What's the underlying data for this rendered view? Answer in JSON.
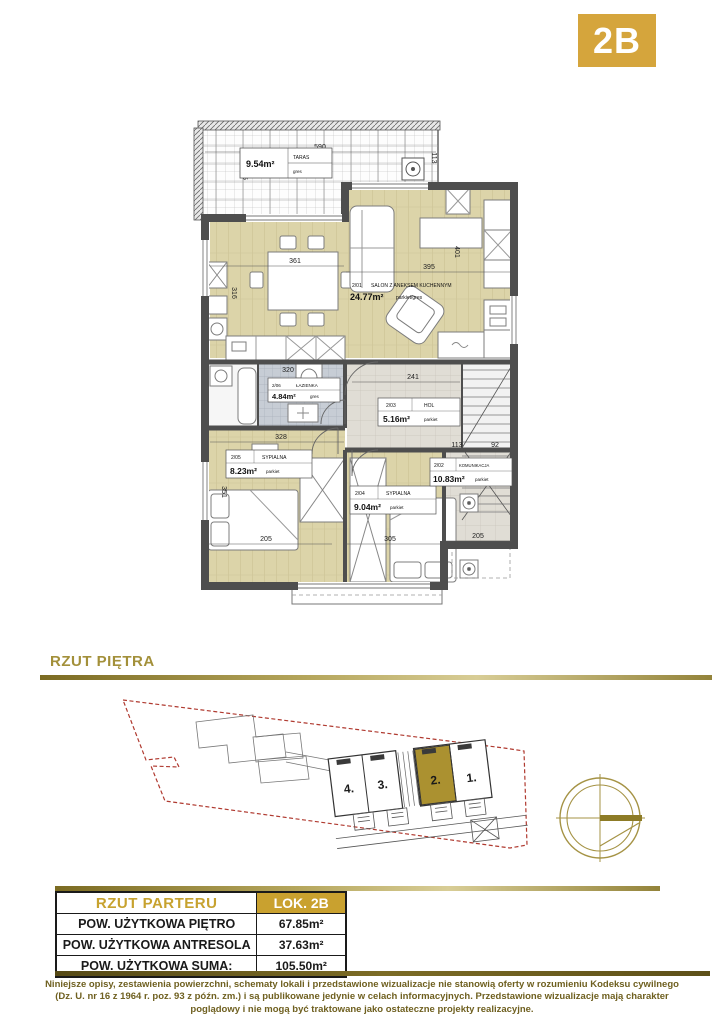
{
  "badge": {
    "label": "2B",
    "color": "#d5a53c"
  },
  "section_title": "RZUT PIĘTRA",
  "floor_plan": {
    "rooms": [
      {
        "id": "2/01",
        "name": "SALON Z ANEKSEM KUCHENNYM",
        "area": "24.77m²",
        "floor": "parkiet/gres"
      },
      {
        "id": "2/02",
        "name": "KOMUNIKACJA",
        "area": "10.83m²",
        "floor": "parkiet"
      },
      {
        "id": "2/03",
        "name": "HOL",
        "area": "5.16m²",
        "floor": "parkiet"
      },
      {
        "id": "2/04",
        "name": "SYPIALNA",
        "area": "9.04m²",
        "floor": "parkiet"
      },
      {
        "id": "2/05",
        "name": "SYPIALNA",
        "area": "8.23m²",
        "floor": "parkiet"
      },
      {
        "id": "2/06",
        "name": "ŁAZIENKA",
        "area": "4.84m²",
        "floor": "gres"
      },
      {
        "name": "TARAS",
        "area": "9.54m²",
        "floor": "gres"
      }
    ],
    "dimensions": {
      "terrace_width": "590",
      "terrace_side": "113",
      "terrace_depth": "205",
      "kitchen_width": "361",
      "kitchen_depth": "316",
      "salon_width": "395",
      "salon_depth": "401",
      "bath_width": "320",
      "hol_width": "241",
      "bedroom5_width": "328",
      "bedroom5_depth": "351",
      "bedroom5_bottom": "205",
      "bedroom4_width": "305",
      "komunikacja_w1": "113",
      "komunikacja_w2": "92",
      "komunikacja_bottom": "205"
    }
  },
  "site_plan": {
    "units": [
      {
        "label": "4.",
        "highlighted": false
      },
      {
        "label": "3.",
        "highlighted": false
      },
      {
        "label": "2.",
        "highlighted": true
      },
      {
        "label": "1.",
        "highlighted": false
      }
    ],
    "highlight_color": "#ab9130",
    "boundary_color": "#b03a30"
  },
  "icons": {
    "compass": "compass-rose"
  },
  "table": {
    "header": {
      "left": "RZUT PARTERU",
      "right": "LOK. 2B"
    },
    "rows": [
      {
        "label": "POW. UŻYTKOWA PIĘTRO",
        "value": "67.85m²"
      },
      {
        "label": "POW. UŻYTKOWA ANTRESOLA",
        "value": "37.63m²"
      },
      {
        "label": "POW. UŻYTKOWA SUMA:",
        "value": "105.50m²"
      }
    ]
  },
  "footer": {
    "text": "Niniejsze opisy, zestawienia powierzchni, schematy lokali i przedstawione wizualizacje nie stanowią oferty w rozumieniu Kodeksu cywilnego (Dz. U. nr 16 z 1964 r. poz. 93 z późn. zm.) i są publikowane jedynie w celach informacyjnych. Przedstawione wizualizacje mają charakter poglądowy i nie mogą być traktowane jako ostateczne projekty realizacyjne."
  }
}
